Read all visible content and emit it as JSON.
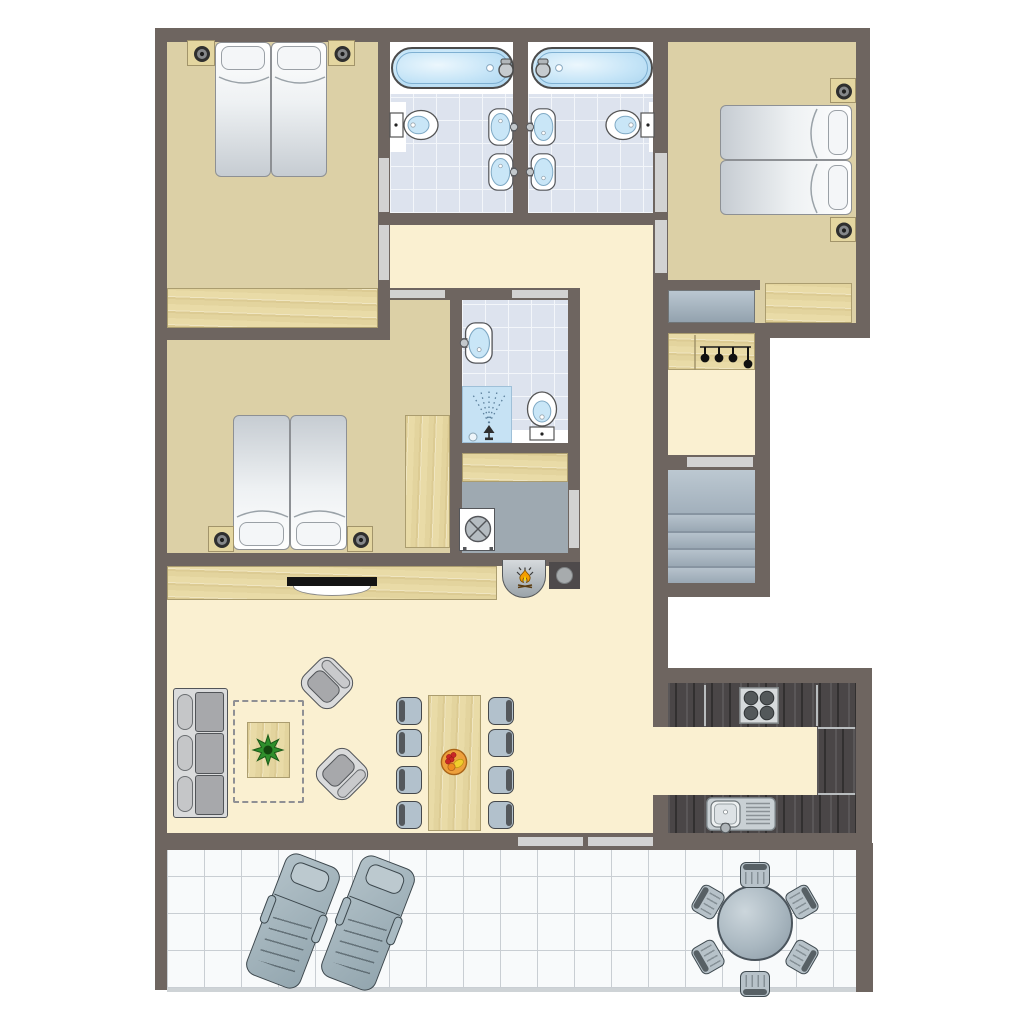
{
  "document": {
    "kind": "apartment-floor-plan",
    "labels_visible": false
  },
  "palette": {
    "wall": "#6e6560",
    "bedroom_floor": "#dcd0a6",
    "hall_floor": "#faf0d1",
    "bath_tile": "#dde3ee",
    "tile_grout": "#f3f6fa",
    "wood": "#e9dba7",
    "kitchen_counter": "#4a4647",
    "laundry_floor": "#9ea9b1",
    "stairs": "#a8b5c1",
    "terrace_tile": "#f8fafb",
    "terrace_line": "#c9ced3",
    "door_gap": "#d2d2d2",
    "furniture_gray": "#a7a8ab",
    "chair_blue": "#b2c1cc",
    "water_blue": "#c4e4f7",
    "flame_orange": "#f59d00",
    "flame_yellow": "#ffd903",
    "plant_green": "#2f8f2c",
    "fruit_bowl": "#eda03c"
  },
  "canvas": {
    "w": 1024,
    "h": 1024,
    "bg": "#ffffff"
  },
  "floors": [
    {
      "n": "bedroom-top-left-floor",
      "f": "tan",
      "x": 167,
      "y": 42,
      "w": 211,
      "h": 286
    },
    {
      "n": "bedroom-top-right-floor",
      "f": "tan",
      "x": 668,
      "y": 42,
      "w": 188,
      "h": 281
    },
    {
      "n": "bedroom-middle-floor",
      "f": "tan",
      "x": 167,
      "y": 340,
      "w": 283,
      "h": 213
    },
    {
      "n": "bedroom-middle-entry-floor",
      "f": "tan",
      "x": 390,
      "y": 300,
      "w": 60,
      "h": 40
    },
    {
      "n": "bathroom-left-tub-zone",
      "f": "white",
      "x": 390,
      "y": 42,
      "w": 123,
      "h": 52
    },
    {
      "n": "bathroom-left-tiles",
      "f": "tile",
      "x": 390,
      "y": 94,
      "w": 123,
      "h": 119
    },
    {
      "n": "bathroom-right-tub-zone",
      "f": "white",
      "x": 528,
      "y": 42,
      "w": 127,
      "h": 52
    },
    {
      "n": "bathroom-right-tiles",
      "f": "tile",
      "x": 528,
      "y": 94,
      "w": 127,
      "h": 119
    },
    {
      "n": "bathroom-left-toilet-backer",
      "f": "white",
      "x": 390,
      "y": 102,
      "w": 16,
      "h": 50
    },
    {
      "n": "bathroom-right-toilet-backer",
      "f": "white",
      "x": 649,
      "y": 102,
      "w": 16,
      "h": 50
    },
    {
      "n": "bathroom-middle-tiles",
      "f": "tile",
      "x": 462,
      "y": 300,
      "w": 106,
      "h": 143
    },
    {
      "n": "bathroom-middle-toilet-backer",
      "f": "white",
      "x": 512,
      "y": 430,
      "w": 56,
      "h": 13
    },
    {
      "n": "laundry-floor",
      "f": "gray",
      "x": 462,
      "y": 482,
      "w": 106,
      "h": 71
    },
    {
      "n": "hallway-upper-floor",
      "f": "cream",
      "x": 390,
      "y": 224,
      "w": 263,
      "h": 64
    },
    {
      "n": "hallway-vertical-floor",
      "f": "cream",
      "x": 580,
      "y": 288,
      "w": 73,
      "h": 277
    },
    {
      "n": "hallway-stairs-floor",
      "f": "cream",
      "x": 668,
      "y": 338,
      "w": 87,
      "h": 117
    },
    {
      "n": "living-room-floor",
      "f": "cream",
      "x": 167,
      "y": 565,
      "w": 486,
      "h": 268
    },
    {
      "n": "kitchen-floor",
      "f": "cream",
      "x": 668,
      "y": 683,
      "w": 188,
      "h": 150
    },
    {
      "n": "kitchen-passage-floor",
      "f": "cream",
      "x": 653,
      "y": 727,
      "w": 15,
      "h": 68
    },
    {
      "n": "terrace-tiles",
      "f": "terrace",
      "x": 167,
      "y": 850,
      "w": 689,
      "h": 138
    },
    {
      "n": "terrace-edge-shadow",
      "f": "shadow",
      "x": 167,
      "y": 988,
      "w": 689,
      "h": 4
    }
  ],
  "walls": [
    {
      "n": "wall-north",
      "x": 155,
      "y": 28,
      "w": 715,
      "h": 14
    },
    {
      "n": "wall-west",
      "x": 155,
      "y": 28,
      "w": 12,
      "h": 962
    },
    {
      "n": "wall-east-upper",
      "x": 856,
      "y": 28,
      "w": 14,
      "h": 310
    },
    {
      "n": "wall-bedroomTL-east",
      "x": 378,
      "y": 42,
      "w": 12,
      "h": 298
    },
    {
      "n": "wall-bath-central",
      "x": 513,
      "y": 42,
      "w": 15,
      "h": 182
    },
    {
      "n": "wall-corridor-east",
      "x": 653,
      "y": 42,
      "w": 15,
      "h": 685
    },
    {
      "n": "wall-bath-south",
      "x": 378,
      "y": 213,
      "w": 290,
      "h": 12
    },
    {
      "n": "wall-bedroomTL-south",
      "x": 155,
      "y": 328,
      "w": 235,
      "h": 12
    },
    {
      "n": "wall-middle-north",
      "x": 378,
      "y": 288,
      "w": 202,
      "h": 12
    },
    {
      "n": "wall-bedroomML-east",
      "x": 450,
      "y": 300,
      "w": 12,
      "h": 253
    },
    {
      "n": "wall-column-east",
      "x": 568,
      "y": 300,
      "w": 12,
      "h": 260
    },
    {
      "n": "wall-bathM-south",
      "x": 462,
      "y": 443,
      "w": 106,
      "h": 10
    },
    {
      "n": "wall-living-north",
      "x": 155,
      "y": 553,
      "w": 425,
      "h": 13
    },
    {
      "n": "wall-niche-north",
      "x": 653,
      "y": 280,
      "w": 107,
      "h": 10
    },
    {
      "n": "wall-bedroomTR-south",
      "x": 653,
      "y": 323,
      "w": 217,
      "h": 15
    },
    {
      "n": "wall-stairs-east",
      "x": 755,
      "y": 338,
      "w": 15,
      "h": 259
    },
    {
      "n": "wall-stairs-north",
      "x": 668,
      "y": 455,
      "w": 87,
      "h": 15
    },
    {
      "n": "wall-stairs-south",
      "x": 653,
      "y": 583,
      "w": 117,
      "h": 14
    },
    {
      "n": "wall-kitchen-north",
      "x": 653,
      "y": 668,
      "w": 219,
      "h": 15
    },
    {
      "n": "wall-kitchen-east",
      "x": 856,
      "y": 668,
      "w": 16,
      "h": 182
    },
    {
      "n": "wall-south",
      "x": 155,
      "y": 833,
      "w": 717,
      "h": 17
    },
    {
      "n": "wall-living-east-lower",
      "x": 653,
      "y": 795,
      "w": 15,
      "h": 38
    },
    {
      "n": "wall-terrace-east",
      "x": 856,
      "y": 843,
      "w": 17,
      "h": 149
    }
  ],
  "doors": [
    {
      "n": "door-bedroomTL-bathL",
      "x": 379,
      "y": 158,
      "w": 10,
      "h": 54
    },
    {
      "n": "door-bedroomTL-hall",
      "x": 379,
      "y": 225,
      "w": 10,
      "h": 55
    },
    {
      "n": "door-bedroomTR-bathR",
      "x": 655,
      "y": 153,
      "w": 12,
      "h": 59
    },
    {
      "n": "door-bedroomTR-hall",
      "x": 655,
      "y": 220,
      "w": 12,
      "h": 53
    },
    {
      "n": "door-hall-bedroomML",
      "x": 390,
      "y": 290,
      "w": 55,
      "h": 8
    },
    {
      "n": "door-hall-bathM",
      "x": 512,
      "y": 290,
      "w": 56,
      "h": 8
    },
    {
      "n": "door-hall-laundry",
      "x": 569,
      "y": 490,
      "w": 10,
      "h": 58
    },
    {
      "n": "door-hall-stairs",
      "x": 687,
      "y": 457,
      "w": 66,
      "h": 10
    },
    {
      "n": "sliding-door-terrace-left",
      "x": 518,
      "y": 837,
      "w": 65,
      "h": 9
    },
    {
      "n": "sliding-door-terrace-right",
      "x": 588,
      "y": 837,
      "w": 65,
      "h": 9
    }
  ],
  "furniture": [
    {
      "t": "stand",
      "n": "nightstand-TL-left",
      "x": 187,
      "y": 40,
      "w": 28,
      "h": 26
    },
    {
      "t": "stand",
      "n": "nightstand-TL-right",
      "x": 328,
      "y": 40,
      "w": 27,
      "h": 26
    },
    {
      "t": "bed",
      "side": "top",
      "n": "bed-TL-1",
      "x": 215,
      "y": 42,
      "w": 56,
      "h": 135
    },
    {
      "t": "bed",
      "side": "top",
      "n": "bed-TL-2",
      "x": 271,
      "y": 42,
      "w": 56,
      "h": 135
    },
    {
      "t": "wood",
      "dir": "h",
      "n": "wardrobe-TL",
      "x": 167,
      "y": 288,
      "w": 211,
      "h": 40
    },
    {
      "t": "tub",
      "faucet": "right",
      "n": "bathtub-left",
      "x": 391,
      "y": 47,
      "w": 123,
      "h": 42
    },
    {
      "t": "tub",
      "faucet": "left",
      "n": "bathtub-right",
      "x": 531,
      "y": 47,
      "w": 122,
      "h": 42
    },
    {
      "t": "toilet",
      "n": "toilet-bathL",
      "x": 389,
      "y": 108,
      "w": 52,
      "h": 34,
      "rot": 0
    },
    {
      "t": "toilet",
      "n": "toilet-bathR",
      "x": 603,
      "y": 108,
      "w": 52,
      "h": 34,
      "rot": 180
    },
    {
      "t": "basin",
      "n": "washbasin-bathL-1",
      "x": 488,
      "y": 108,
      "w": 28,
      "h": 38,
      "rot": 0
    },
    {
      "t": "basin",
      "n": "washbasin-bathL-2",
      "x": 488,
      "y": 153,
      "w": 28,
      "h": 38,
      "rot": 0
    },
    {
      "t": "basin",
      "n": "washbasin-bathR-1",
      "x": 528,
      "y": 108,
      "w": 28,
      "h": 38,
      "rot": 180
    },
    {
      "t": "basin",
      "n": "washbasin-bathR-2",
      "x": 528,
      "y": 153,
      "w": 28,
      "h": 38,
      "rot": 180
    },
    {
      "t": "stand",
      "n": "nightstand-TR-top",
      "x": 830,
      "y": 78,
      "w": 26,
      "h": 25
    },
    {
      "t": "stand",
      "n": "nightstand-TR-bottom",
      "x": 830,
      "y": 217,
      "w": 26,
      "h": 25
    },
    {
      "t": "bed",
      "side": "right",
      "n": "bed-TR-1",
      "x": 720,
      "y": 105,
      "w": 132,
      "h": 55
    },
    {
      "t": "bed",
      "side": "right",
      "n": "bed-TR-2",
      "x": 720,
      "y": 160,
      "w": 132,
      "h": 55
    },
    {
      "t": "wood",
      "dir": "h",
      "n": "wardrobe-TR",
      "x": 765,
      "y": 283,
      "w": 87,
      "h": 40
    },
    {
      "t": "mat",
      "n": "entry-bench",
      "x": 668,
      "y": 290,
      "w": 87,
      "h": 33
    },
    {
      "t": "coatrack",
      "n": "coat-rack",
      "x": 668,
      "y": 333,
      "w": 87,
      "h": 37
    },
    {
      "t": "bed",
      "side": "bottom",
      "n": "bed-ML-1",
      "x": 233,
      "y": 415,
      "w": 57,
      "h": 135
    },
    {
      "t": "bed",
      "side": "bottom",
      "n": "bed-ML-2",
      "x": 290,
      "y": 415,
      "w": 57,
      "h": 135
    },
    {
      "t": "stand",
      "n": "nightstand-ML-left",
      "x": 208,
      "y": 526,
      "w": 26,
      "h": 26
    },
    {
      "t": "stand",
      "n": "nightstand-ML-right",
      "x": 347,
      "y": 526,
      "w": 26,
      "h": 26
    },
    {
      "t": "wood",
      "dir": "v",
      "n": "wardrobe-ML",
      "x": 405,
      "y": 415,
      "w": 45,
      "h": 133
    },
    {
      "t": "basin",
      "n": "washbasin-bathM",
      "x": 462,
      "y": 322,
      "w": 31,
      "h": 42,
      "rot": 180
    },
    {
      "t": "shower",
      "n": "shower",
      "x": 462,
      "y": 386,
      "w": 50,
      "h": 57
    },
    {
      "t": "toilet",
      "n": "toilet-bathM",
      "x": 516,
      "y": 398,
      "w": 52,
      "h": 34,
      "rot": -90
    },
    {
      "t": "wood",
      "dir": "h",
      "n": "closet-shelf",
      "x": 462,
      "y": 453,
      "w": 106,
      "h": 29
    },
    {
      "t": "washer",
      "n": "washing-machine",
      "x": 459,
      "y": 508,
      "w": 36,
      "h": 43
    },
    {
      "t": "stairs",
      "n": "staircase",
      "x": 668,
      "y": 470,
      "w": 87,
      "h": 113
    },
    {
      "t": "fireplace",
      "n": "fireplace",
      "x": 502,
      "y": 560,
      "w": 44,
      "h": 38
    },
    {
      "t": "logbox",
      "n": "log-box",
      "x": 549,
      "y": 562,
      "w": 31,
      "h": 27
    },
    {
      "t": "wood",
      "dir": "h",
      "n": "sideboard",
      "x": 167,
      "y": 566,
      "w": 330,
      "h": 34
    },
    {
      "t": "tv",
      "n": "television",
      "x": 287,
      "y": 577,
      "w": 90,
      "h": 20
    },
    {
      "t": "sofa",
      "n": "sofa",
      "x": 173,
      "y": 688,
      "w": 55,
      "h": 130
    },
    {
      "t": "rug",
      "n": "rug-outline",
      "x": 233,
      "y": 700,
      "w": 71,
      "h": 103
    },
    {
      "t": "wood",
      "dir": "v",
      "n": "coffee-table",
      "x": 247,
      "y": 722,
      "w": 43,
      "h": 56
    },
    {
      "t": "plant",
      "n": "potted-plant",
      "x": 252,
      "y": 734,
      "w": 32,
      "h": 32
    },
    {
      "t": "armchair",
      "back": "top",
      "n": "armchair-1",
      "x": 305,
      "y": 661,
      "w": 44,
      "h": 44,
      "rot": 45
    },
    {
      "t": "armchair",
      "back": "right",
      "n": "armchair-2",
      "x": 320,
      "y": 752,
      "w": 44,
      "h": 44,
      "rot": 45
    },
    {
      "t": "wood",
      "dir": "v",
      "n": "dining-table",
      "x": 428,
      "y": 695,
      "w": 53,
      "h": 136
    },
    {
      "t": "fruit",
      "n": "fruit-bowl",
      "x": 440,
      "y": 748,
      "w": 28,
      "h": 28
    },
    {
      "t": "chair",
      "back": "left",
      "n": "dining-chair-L1",
      "x": 396,
      "y": 697,
      "w": 26,
      "h": 28
    },
    {
      "t": "chair",
      "back": "left",
      "n": "dining-chair-L2",
      "x": 396,
      "y": 729,
      "w": 26,
      "h": 28
    },
    {
      "t": "chair",
      "back": "left",
      "n": "dining-chair-L3",
      "x": 396,
      "y": 766,
      "w": 26,
      "h": 28
    },
    {
      "t": "chair",
      "back": "left",
      "n": "dining-chair-L4",
      "x": 396,
      "y": 801,
      "w": 26,
      "h": 28
    },
    {
      "t": "chair",
      "back": "right",
      "n": "dining-chair-R1",
      "x": 488,
      "y": 697,
      "w": 26,
      "h": 28
    },
    {
      "t": "chair",
      "back": "right",
      "n": "dining-chair-R2",
      "x": 488,
      "y": 729,
      "w": 26,
      "h": 28
    },
    {
      "t": "chair",
      "back": "right",
      "n": "dining-chair-R3",
      "x": 488,
      "y": 766,
      "w": 26,
      "h": 28
    },
    {
      "t": "chair",
      "back": "right",
      "n": "dining-chair-R4",
      "x": 488,
      "y": 801,
      "w": 26,
      "h": 28
    },
    {
      "t": "counter",
      "n": "kitchen-counter-north",
      "x": 668,
      "y": 683,
      "w": 188,
      "h": 44
    },
    {
      "t": "counter",
      "n": "kitchen-counter-east",
      "x": 817,
      "y": 727,
      "w": 39,
      "h": 68
    },
    {
      "t": "counter",
      "n": "kitchen-counter-south",
      "x": 668,
      "y": 795,
      "w": 188,
      "h": 38
    },
    {
      "t": "seam",
      "n": "counter-seam-1",
      "x": 704,
      "y": 685,
      "w": 2,
      "h": 41
    },
    {
      "t": "seam",
      "n": "counter-seam-2",
      "x": 816,
      "y": 685,
      "w": 2,
      "h": 41
    },
    {
      "t": "seam",
      "n": "counter-seam-3",
      "x": 818,
      "y": 727,
      "w": 37,
      "h": 2
    },
    {
      "t": "seam",
      "n": "counter-seam-4",
      "x": 818,
      "y": 793,
      "w": 37,
      "h": 2
    },
    {
      "t": "stove",
      "n": "stove-4-burners",
      "x": 739,
      "y": 687,
      "w": 40,
      "h": 37
    },
    {
      "t": "sink",
      "n": "kitchen-sink",
      "x": 706,
      "y": 797,
      "w": 70,
      "h": 34
    },
    {
      "t": "lounger",
      "n": "sun-lounger-1",
      "x": 264,
      "y": 856,
      "w": 58,
      "h": 130,
      "rot": 21
    },
    {
      "t": "lounger",
      "n": "sun-lounger-2",
      "x": 339,
      "y": 858,
      "w": 58,
      "h": 130,
      "rot": 21
    },
    {
      "t": "tableround",
      "n": "terrace-round-table",
      "x": 717,
      "y": 885,
      "w": 76,
      "h": 76
    },
    {
      "t": "tchair",
      "n": "terrace-chair-top",
      "x": 740,
      "y": 862,
      "w": 30,
      "h": 26,
      "rot": 0
    },
    {
      "t": "tchair",
      "n": "terrace-chair-topright",
      "x": 787,
      "y": 889,
      "w": 30,
      "h": 26,
      "rot": 60
    },
    {
      "t": "tchair",
      "n": "terrace-chair-bottomright",
      "x": 787,
      "y": 944,
      "w": 30,
      "h": 26,
      "rot": 120
    },
    {
      "t": "tchair",
      "n": "terrace-chair-bottom",
      "x": 740,
      "y": 971,
      "w": 30,
      "h": 26,
      "rot": 180
    },
    {
      "t": "tchair",
      "n": "terrace-chair-bottomleft",
      "x": 693,
      "y": 944,
      "w": 30,
      "h": 26,
      "rot": 240
    },
    {
      "t": "tchair",
      "n": "terrace-chair-topleft",
      "x": 693,
      "y": 889,
      "w": 30,
      "h": 26,
      "rot": 300
    }
  ]
}
